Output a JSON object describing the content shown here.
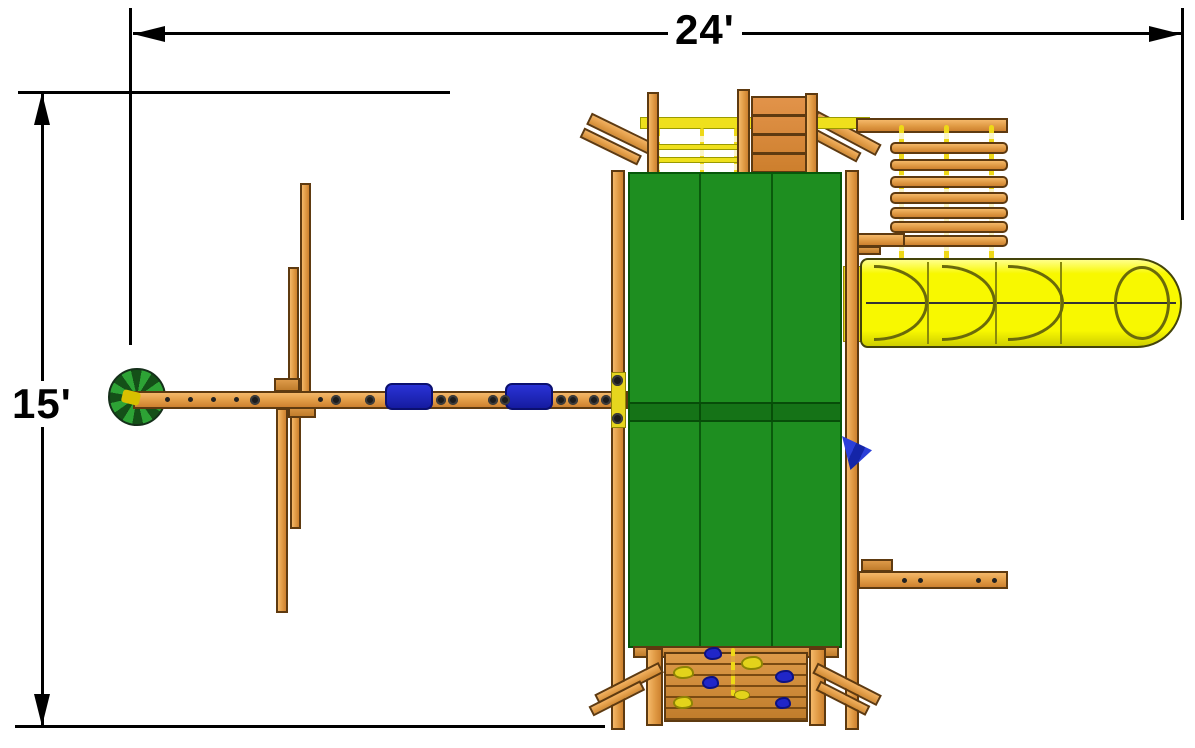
{
  "title": "Playset footprint plan view",
  "dimensions": {
    "width_label": "24'",
    "height_label": "15'"
  },
  "colors": {
    "dimension_lines": "#000000",
    "wood": "#e09a44",
    "canopy_green": "#1e8e20",
    "slide_yellow": "#f8f800",
    "rope_yellow": "#eed817",
    "swing_seat_blue": "#2026c8",
    "flag_blue": "#2b3fd8",
    "disc_swing_green": "#2da335"
  },
  "components": [
    "dimension-24ft",
    "dimension-15ft",
    "tower-canopy",
    "tube-slide",
    "monkey-bars",
    "climbing-ramp",
    "rope-ladder",
    "swing-beam",
    "belt-swing-1",
    "belt-swing-2",
    "disc-swing",
    "a-frame-legs",
    "rock-climbing-wall",
    "side-beam",
    "flag"
  ]
}
